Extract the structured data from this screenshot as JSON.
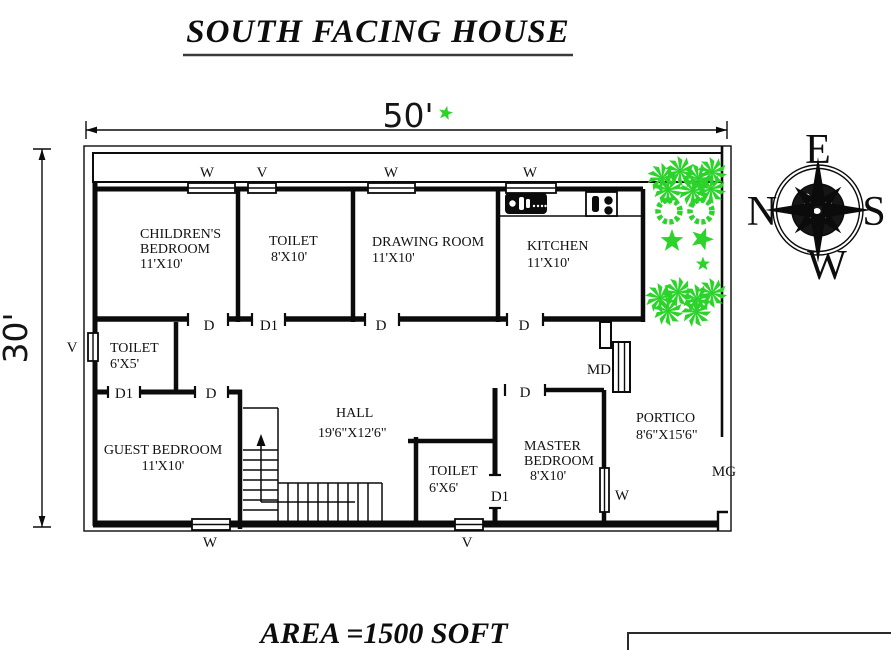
{
  "page": {
    "title": "SOUTH FACING HOUSE",
    "area_label": "AREA =1500 SOFT"
  },
  "dimensions": {
    "width_label": "50'",
    "height_label": "30'"
  },
  "compass": {
    "top": "E",
    "left": "N",
    "right": "S",
    "bottom": "W"
  },
  "rooms": {
    "childrens_bedroom": {
      "name1": "CHILDREN'S",
      "name2": "BEDROOM",
      "size": "11'X10'"
    },
    "toilet_top": {
      "name1": "TOILET",
      "size": "8'X10'"
    },
    "drawing_room": {
      "name1": "DRAWING ROOM",
      "size": "11'X10'"
    },
    "kitchen": {
      "name1": "KITCHEN",
      "size": "11'X10'"
    },
    "toilet_left": {
      "name1": "TOILET",
      "size": "6'X5'"
    },
    "guest_bedroom": {
      "name1": "GUEST BEDROOM",
      "size": "11'X10'"
    },
    "hall": {
      "name1": "HALL",
      "size": "19'6\"X12'6\""
    },
    "toilet_mid": {
      "name1": "TOILET",
      "size": "6'X6'"
    },
    "master_bedroom": {
      "name1": "MASTER",
      "name2": "BEDROOM",
      "size": "8'X10'"
    },
    "portico": {
      "name1": "PORTICO",
      "size": "8'6\"X15'6\""
    }
  },
  "openings": {
    "window": "W",
    "ventilator": "V",
    "door": "D",
    "door_small": "D1",
    "main_door": "MD",
    "main_gate": "MG"
  },
  "colors": {
    "plant_green": "#2bd32b",
    "line": "#0b0b0b"
  }
}
